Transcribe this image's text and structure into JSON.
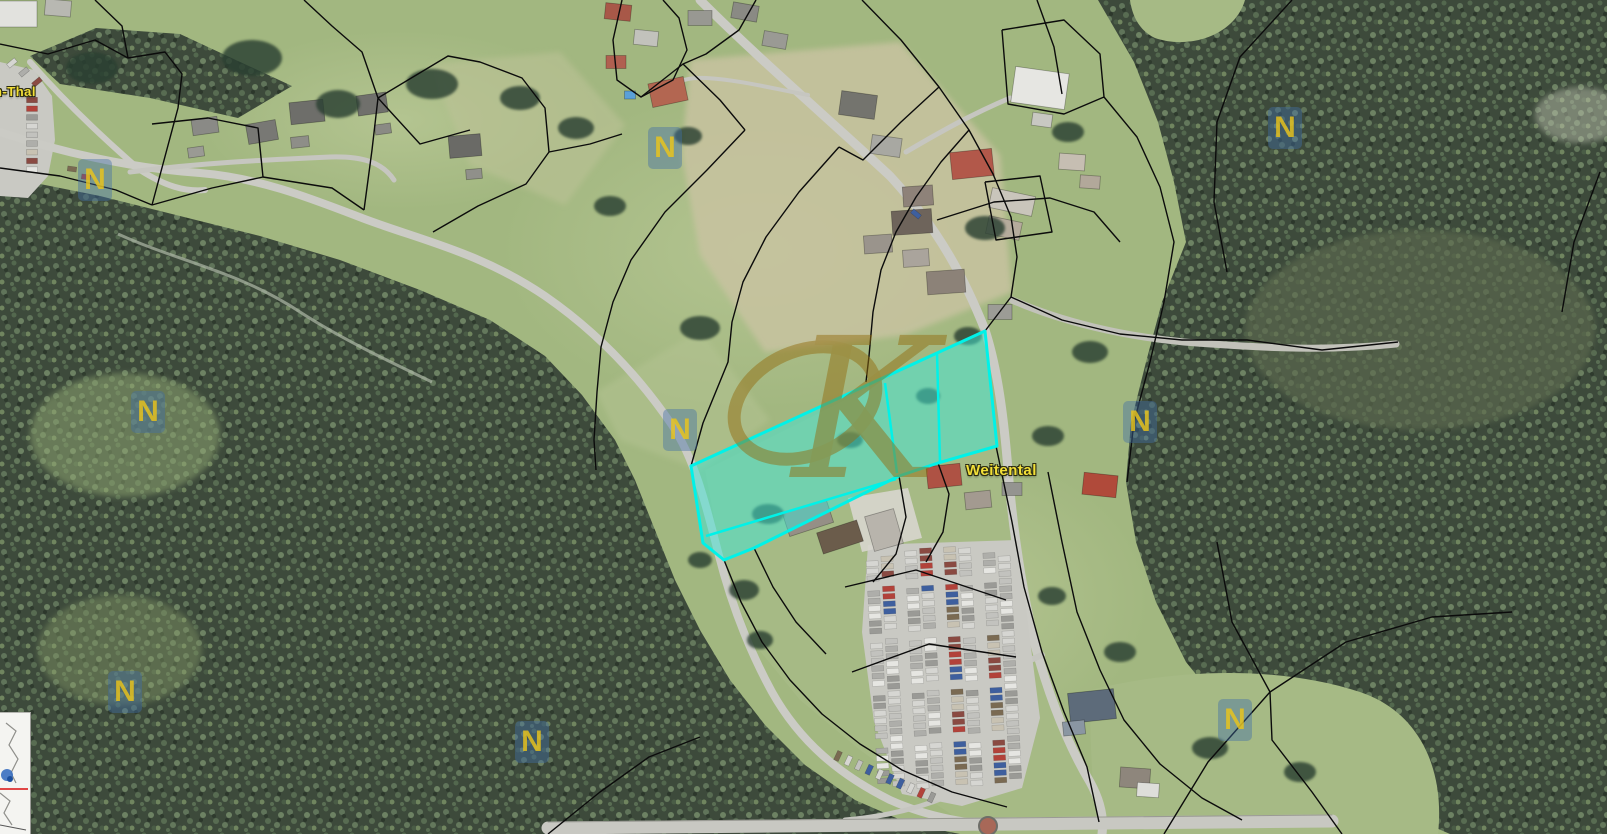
{
  "app": {
    "type": "aerial-cadastral-map-view"
  },
  "labels": {
    "place_partial": "n-Thal",
    "place_main": "Weitental",
    "partial_pos": [
      -6,
      84
    ],
    "main_pos": [
      966,
      462
    ],
    "fill": "#f2df38",
    "outline": "#2a2a10"
  },
  "highlight_parcel": {
    "stroke": "#00f2e8",
    "fill": "rgba(62,232,216,0.5)",
    "outer": [
      [
        691,
        466
      ],
      [
        985,
        331
      ],
      [
        997,
        446
      ],
      [
        938,
        463
      ],
      [
        899,
        476
      ],
      [
        754,
        548
      ],
      [
        724,
        560
      ],
      [
        703,
        543
      ]
    ],
    "inner_lines": [
      [
        [
          937,
          353
        ],
        [
          940,
          462
        ]
      ],
      [
        [
          885,
          383
        ],
        [
          897,
          473
        ]
      ],
      [
        [
          706,
          536
        ],
        [
          896,
          479
        ]
      ]
    ]
  },
  "watermarks": {
    "brand_glyph": "K",
    "brand_color": "rgba(148,110,18,0.9)",
    "grid_glyph": "N",
    "grid_bg": "rgba(64,110,168,0.42)",
    "grid_fg": "rgba(238,198,24,0.8)",
    "grid_positions": [
      [
        95,
        180
      ],
      [
        665,
        148
      ],
      [
        1285,
        128
      ],
      [
        148,
        412
      ],
      [
        680,
        430
      ],
      [
        1140,
        422
      ],
      [
        125,
        692
      ],
      [
        532,
        742
      ],
      [
        1235,
        720
      ]
    ]
  },
  "inset": {
    "bg": "#f4f4f1",
    "line_color": "#8f8f8b",
    "marker_color": "#3a6fc0",
    "marker_core": "#1c4f9e",
    "route_color": "#e04646"
  },
  "palette": {
    "meadow": "#a2b780",
    "meadow_light": "#bcc998",
    "field_tan": "#c8c3a0",
    "forest": "#3d4a3b",
    "forest_light": "#5d6b50",
    "road": "#cbcbc5",
    "boundary": "#0b0b0b",
    "car_colors": [
      "#d6d6d2",
      "#c2c2be",
      "#aeaeaa",
      "#e6e6e2",
      "#9a9a96",
      "#b2423a",
      "#3e5f9e",
      "#7a6a52",
      "#c8c2b2",
      "#8a4a42"
    ]
  }
}
